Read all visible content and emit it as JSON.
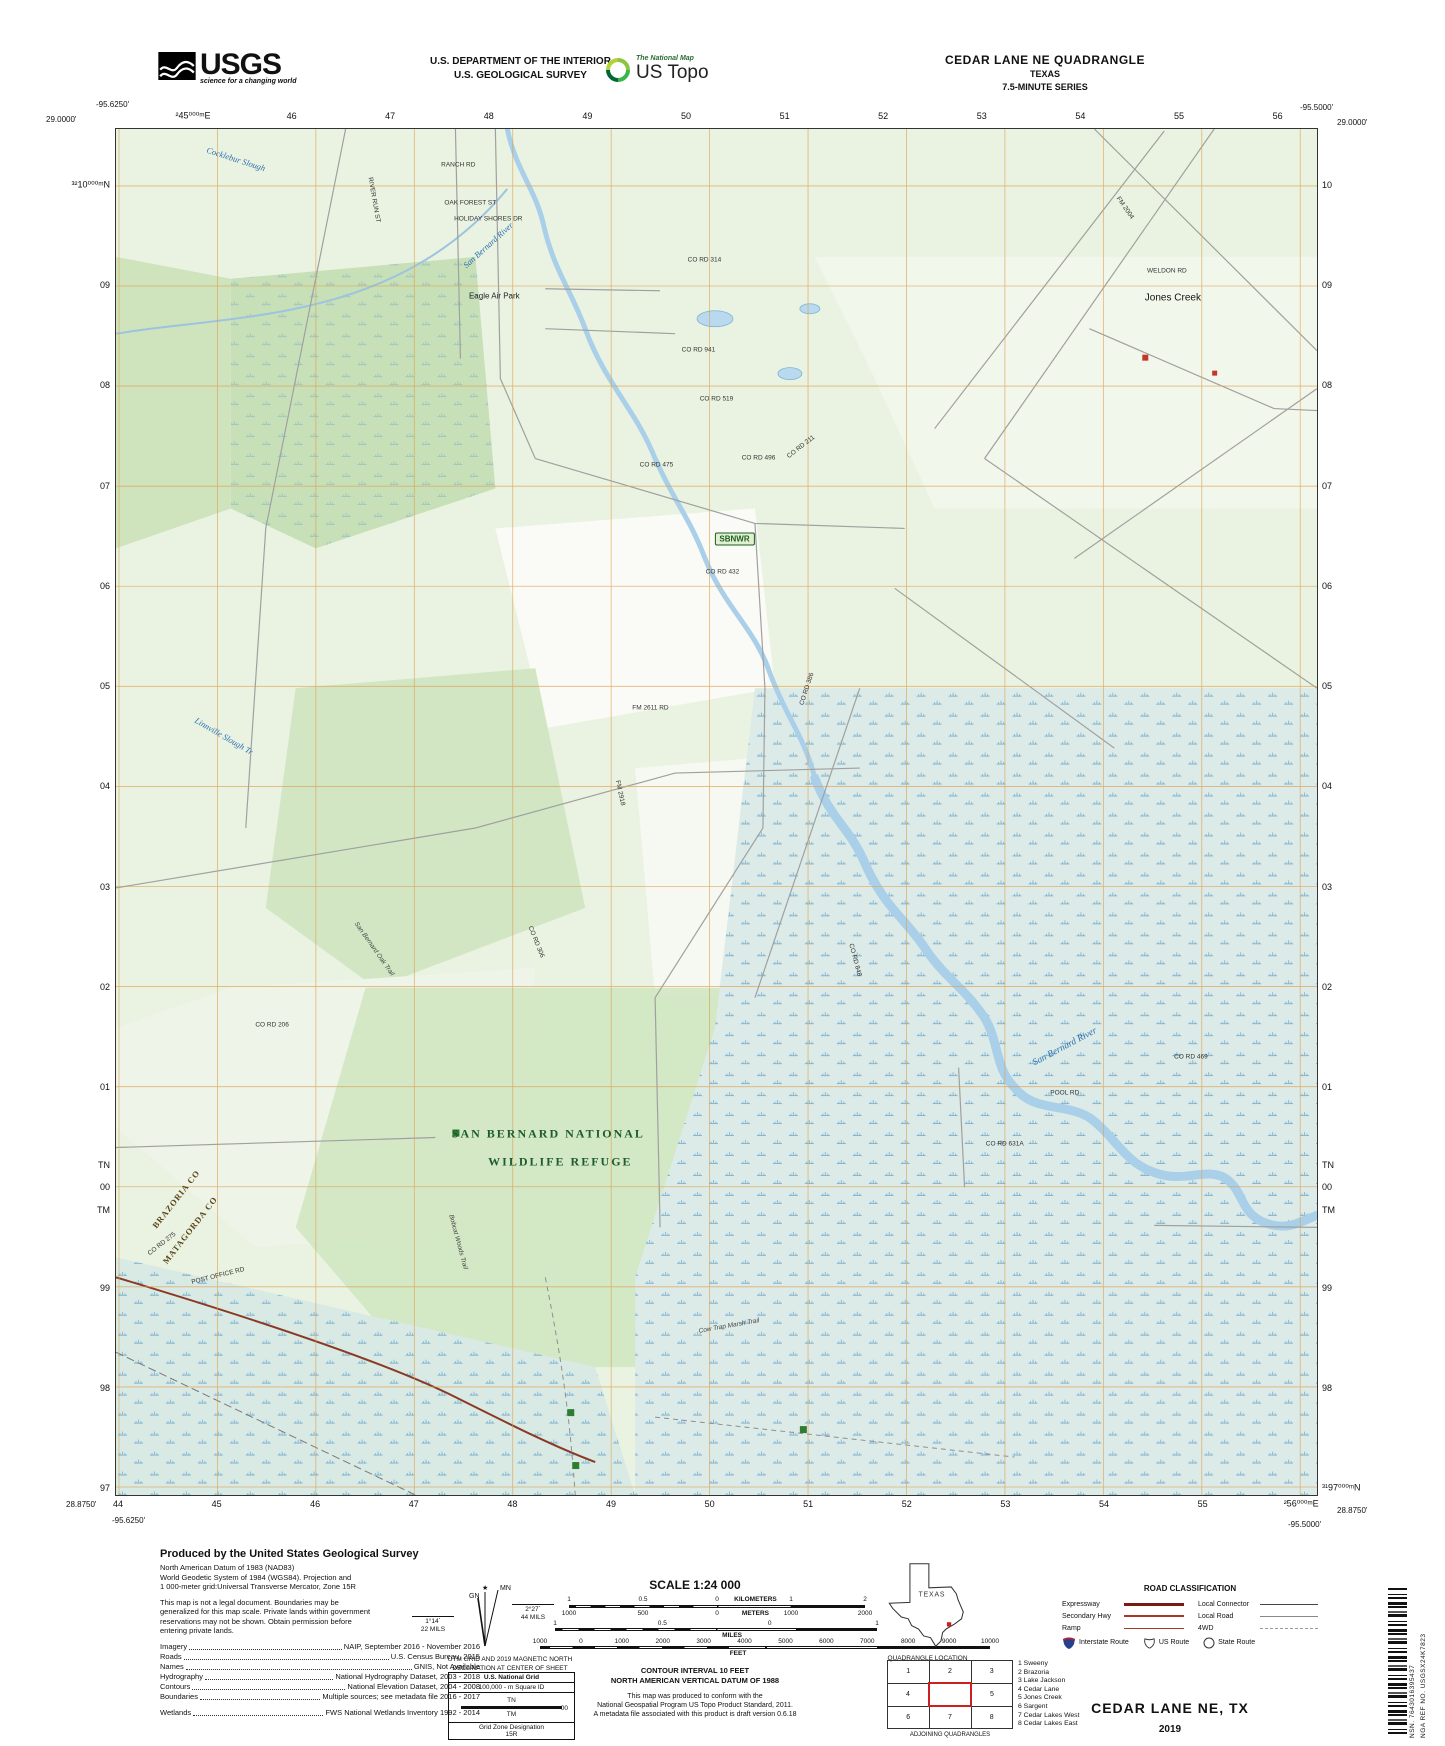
{
  "header": {
    "usgs_logo": {
      "text": "USGS",
      "tagline": "science for a changing world"
    },
    "dept_line1": "U.S. DEPARTMENT OF THE INTERIOR",
    "dept_line2": "U.S. GEOLOGICAL SURVEY",
    "ustopo_logo": {
      "small": "The National Map",
      "large": "US Topo"
    },
    "quad_title": "CEDAR LANE NE QUADRANGLE",
    "quad_state": "TEXAS",
    "quad_series": "7.5-MINUTE SERIES"
  },
  "map": {
    "corners": {
      "tl_lon": "-95.6250'",
      "tl_lat": "29.0000'",
      "tr_lon": "-95.5000'",
      "tr_lat": "29.0000'",
      "bl_lat": "28.8750'",
      "bl_lon": "-95.6250'",
      "br_lon": "-95.5000'",
      "br_lat": "28.8750'"
    },
    "grid": {
      "top": [
        "²45⁰⁰⁰ᵐE",
        "46",
        "47",
        "48",
        "49",
        "50",
        "51",
        "52",
        "53",
        "54",
        "55",
        "56"
      ],
      "bottom": [
        "44",
        "45",
        "46",
        "47",
        "48",
        "49",
        "50",
        "51",
        "52",
        "53",
        "54",
        "55",
        "²56⁰⁰⁰ᵐE"
      ],
      "left": [
        "³²10⁰⁰⁰ᵐN",
        "09",
        "08",
        "07",
        "06",
        "05",
        "04",
        "03",
        "02",
        "01",
        "00",
        "99",
        "98",
        "97"
      ],
      "right": [
        "10",
        "09",
        "08",
        "07",
        "06",
        "05",
        "04",
        "03",
        "02",
        "01",
        "00",
        "99",
        "98",
        "³¹97⁰⁰⁰ᵐN"
      ],
      "tn": "TN",
      "tm": "TM"
    },
    "labels": [
      {
        "text": "Cocklebur Slough",
        "x": 10,
        "y": 2.2,
        "rot": 18,
        "cls": "water"
      },
      {
        "text": "San Bernard River",
        "x": 31,
        "y": 8.5,
        "rot": -42,
        "cls": "water"
      },
      {
        "text": "Eagle Air Park",
        "x": 31.5,
        "y": 12.2,
        "rot": 0,
        "cls": "place"
      },
      {
        "text": "RANCH RD",
        "x": 28.5,
        "y": 2.6,
        "rot": 0,
        "cls": "road"
      },
      {
        "text": "OAK FOREST ST",
        "x": 29.5,
        "y": 5.4,
        "rot": 0,
        "cls": "road"
      },
      {
        "text": "HOLIDAY SHORES DR",
        "x": 31,
        "y": 6.6,
        "rot": 0,
        "cls": "road"
      },
      {
        "text": "RIVER RUN ST",
        "x": 21.5,
        "y": 5.2,
        "rot": 80,
        "cls": "road"
      },
      {
        "text": "CO RD 314",
        "x": 49,
        "y": 9.6,
        "rot": 0,
        "cls": "road"
      },
      {
        "text": "FM 2004",
        "x": 84,
        "y": 5.8,
        "rot": 55,
        "cls": "road"
      },
      {
        "text": "WELDON RD",
        "x": 87.5,
        "y": 10.4,
        "rot": 0,
        "cls": "road"
      },
      {
        "text": "Jones Creek",
        "x": 88,
        "y": 12.4,
        "rot": 0,
        "cls": "place-big"
      },
      {
        "text": "CO RD 941",
        "x": 48.5,
        "y": 16.2,
        "rot": 0,
        "cls": "road"
      },
      {
        "text": "CO RD 519",
        "x": 50,
        "y": 19.8,
        "rot": 0,
        "cls": "road"
      },
      {
        "text": "CO RD 475",
        "x": 45,
        "y": 24.6,
        "rot": 0,
        "cls": "road"
      },
      {
        "text": "CO RD 496",
        "x": 53.5,
        "y": 24.1,
        "rot": 0,
        "cls": "road"
      },
      {
        "text": "CO RD 211",
        "x": 57,
        "y": 23.3,
        "rot": -38,
        "cls": "road"
      },
      {
        "text": "SBNWR",
        "x": 51.5,
        "y": 30,
        "rot": 0,
        "cls": "refuge-badge"
      },
      {
        "text": "CO RD 432",
        "x": 50.5,
        "y": 32.4,
        "rot": 0,
        "cls": "road"
      },
      {
        "text": "FM 2611 RD",
        "x": 44.5,
        "y": 42.4,
        "rot": 0,
        "cls": "road"
      },
      {
        "text": "CO RD 386",
        "x": 57.5,
        "y": 41,
        "rot": -72,
        "cls": "road"
      },
      {
        "text": "FM 2918",
        "x": 42,
        "y": 48.6,
        "rot": 78,
        "cls": "road"
      },
      {
        "text": "Linnville Slough Tr",
        "x": 9,
        "y": 44.4,
        "rot": 30,
        "cls": "water"
      },
      {
        "text": "San Bernard Oak Trail",
        "x": 21.5,
        "y": 60,
        "rot": 55,
        "cls": "trail"
      },
      {
        "text": "CO RD 206",
        "x": 13,
        "y": 65.6,
        "rot": 0,
        "cls": "road"
      },
      {
        "text": "CO RD 306",
        "x": 35,
        "y": 59.5,
        "rot": 68,
        "cls": "road"
      },
      {
        "text": "CO RD 848",
        "x": 61.5,
        "y": 60.8,
        "rot": 75,
        "cls": "road"
      },
      {
        "text": "SAN BERNARD NATIONAL",
        "x": 36,
        "y": 73.6,
        "rot": 0,
        "cls": "refuge-big"
      },
      {
        "text": "WILDLIFE REFUGE",
        "x": 37,
        "y": 75.6,
        "rot": 0,
        "cls": "refuge-big"
      },
      {
        "text": "San Bernard River",
        "x": 79,
        "y": 67.2,
        "rot": -28,
        "cls": "water-big"
      },
      {
        "text": "POOL RD",
        "x": 79,
        "y": 70.6,
        "rot": 0,
        "cls": "road"
      },
      {
        "text": "CO RD 469",
        "x": 89.5,
        "y": 67.9,
        "rot": 0,
        "cls": "road"
      },
      {
        "text": "CO RD 631A",
        "x": 74,
        "y": 74.3,
        "rot": 0,
        "cls": "road"
      },
      {
        "text": "BRAZORIA CO",
        "x": 5,
        "y": 78.3,
        "rot": -52,
        "cls": "county"
      },
      {
        "text": "MATAGORDA CO",
        "x": 6.2,
        "y": 80.6,
        "rot": -52,
        "cls": "county"
      },
      {
        "text": "CO RD 275",
        "x": 3.8,
        "y": 81.6,
        "rot": -38,
        "cls": "road"
      },
      {
        "text": "POST OFFICE RD",
        "x": 8.5,
        "y": 84,
        "rot": -14,
        "cls": "road"
      },
      {
        "text": "Bobcat Woods Trail",
        "x": 28.5,
        "y": 81.5,
        "rot": 75,
        "cls": "trail"
      },
      {
        "text": "Cow Trap Marsh Trail",
        "x": 51,
        "y": 87.6,
        "rot": -10,
        "cls": "trail"
      }
    ]
  },
  "footer": {
    "produced_by": "Produced by the United States Geological Survey",
    "datum_lines": [
      "North American Datum of 1983 (NAD83)",
      "World Geodetic System of 1984 (WGS84).  Projection and",
      "1 000-meter grid:Universal Transverse Mercator, Zone 15R"
    ],
    "legal_lines": [
      "This map is not a legal document. Boundaries may be",
      "generalized for this map scale. Private lands within government",
      "reservations may not be shown. Obtain permission before",
      "entering private lands."
    ],
    "sources": [
      {
        "label": "Imagery",
        "value": "NAIP, September 2016 - November 2016"
      },
      {
        "label": "Roads",
        "value": "U.S. Census Bureau, 2015"
      },
      {
        "label": "Names",
        "value": "GNIS, Not Available"
      },
      {
        "label": "Hydrography",
        "value": "National Hydrography Dataset, 2003 - 2018"
      },
      {
        "label": "Contours",
        "value": "National Elevation Dataset, 2004 - 2008"
      },
      {
        "label": "Boundaries",
        "value": "Multiple sources; see metadata file 2016 - 2017"
      },
      {
        "label": "Wetlands",
        "value": "FWS National Wetlands Inventory 1992 - 2014"
      }
    ],
    "declination": {
      "mn": "MN",
      "gn": "GN",
      "left_deg": "1°14´",
      "left_mils": "22 MILS",
      "right_deg": "2°27´",
      "right_mils": "44 MILS",
      "caption1": "UTM GRID AND 2019 MAGNETIC NORTH",
      "caption2": "DECLINATION AT CENTER OF SHEET"
    },
    "usng": {
      "title": "U.S. National Grid",
      "sq": "100,000 - m Square ID",
      "tn": "TN",
      "tm": "TM",
      "val": "00",
      "gzd_label": "Grid Zone Designation",
      "gzd": "15R"
    },
    "scale": {
      "title": "SCALE 1:24 000",
      "km_label": "KILOMETERS",
      "km_ticks": [
        "1",
        "0.5",
        "0",
        "1",
        "2"
      ],
      "m_label": "METERS",
      "m_ticks": [
        "1000",
        "500",
        "0",
        "1000",
        "2000"
      ],
      "mi_label": "MILES",
      "mi_ticks": [
        "1",
        "0.5",
        "0",
        "1"
      ],
      "ft_label": "FEET",
      "ft_ticks": [
        "1000",
        "0",
        "1000",
        "2000",
        "3000",
        "4000",
        "5000",
        "6000",
        "7000",
        "8000",
        "9000",
        "10000"
      ]
    },
    "contour1": "CONTOUR INTERVAL 10 FEET",
    "contour2": "NORTH AMERICAN VERTICAL DATUM OF 1988",
    "standard_lines": [
      "This map was produced to conform with the",
      "National Geospatial Program US Topo Product Standard, 2011.",
      "A metadata file associated with this product is draft version 0.6.18"
    ],
    "texas": {
      "label": "TEXAS",
      "caption": "QUADRANGLE LOCATION"
    },
    "adjoining": {
      "cells": [
        "1",
        "2",
        "3",
        "4",
        "",
        "5",
        "6",
        "7",
        "8"
      ],
      "caption": "ADJOINING QUADRANGLES",
      "names": [
        "1 Sweeny",
        "2 Brazoria",
        "3 Lake Jackson",
        "4 Cedar Lane",
        "5 Jones Creek",
        "6 Sargent",
        "7 Cedar Lakes West",
        "8 Cedar Lakes East"
      ]
    },
    "road_class": {
      "title": "ROAD CLASSIFICATION",
      "rows": [
        {
          "l": "Expressway",
          "r": "Local Connector"
        },
        {
          "l": "Secondary Hwy",
          "r": "Local Road"
        },
        {
          "l": "Ramp",
          "r": "4WD"
        }
      ],
      "shields": [
        "Interstate Route",
        "US Route",
        "State Route"
      ]
    },
    "sheet_title": "CEDAR LANE NE,  TX",
    "sheet_year": "2019",
    "barcode": {
      "nsn": "NSN. 7643016395437",
      "nga": "NGA REF NO. USGSX24K7823"
    }
  },
  "colors": {
    "grid_orange": "#dd9f4e",
    "water_blue": "#a9cfe9",
    "veg_green": "#eaf3e2",
    "wetland_teal": "#dcebe7",
    "refuge_green": "#cfe5c0",
    "route_red": "#8a3a24"
  }
}
